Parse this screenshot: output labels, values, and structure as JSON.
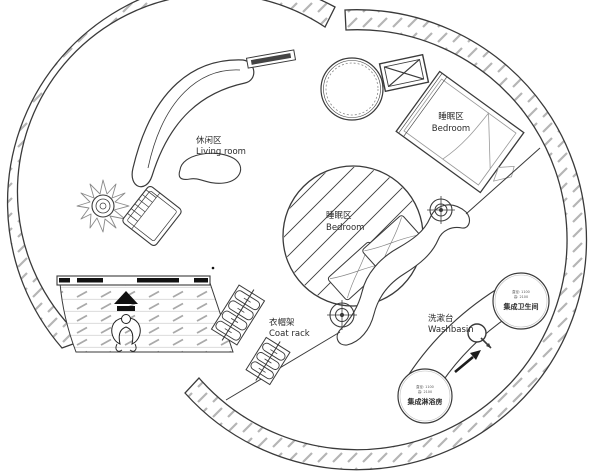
{
  "plan": {
    "title": "Round cabin floor plan",
    "areas": {
      "living_room": {
        "zh": "休闲区",
        "en": "Living room"
      },
      "bedroom_upper": {
        "zh": "睡眠区",
        "en": "Bedroom"
      },
      "bedroom_center": {
        "zh": "睡眠区",
        "en": "Bedroom"
      },
      "coat_rack": {
        "zh": "衣帽架",
        "en": "Coat rack"
      },
      "washbasin": {
        "zh": "洗漱台",
        "en": "Washbasin"
      },
      "integrated_bathroom": {
        "zh": "集成卫生间",
        "dims": [
          "直径: 1100",
          "高: 2100"
        ]
      },
      "integrated_shower": {
        "zh": "集成淋浴房",
        "dims": [
          "直径: 1100",
          "高: 2100"
        ]
      }
    },
    "colors": {
      "line": "#3a3a3a",
      "hatch": "#b5b5b5",
      "deck_line": "#a9a9a9",
      "paper": "#ffffff",
      "text": "#2b2b2b"
    }
  }
}
